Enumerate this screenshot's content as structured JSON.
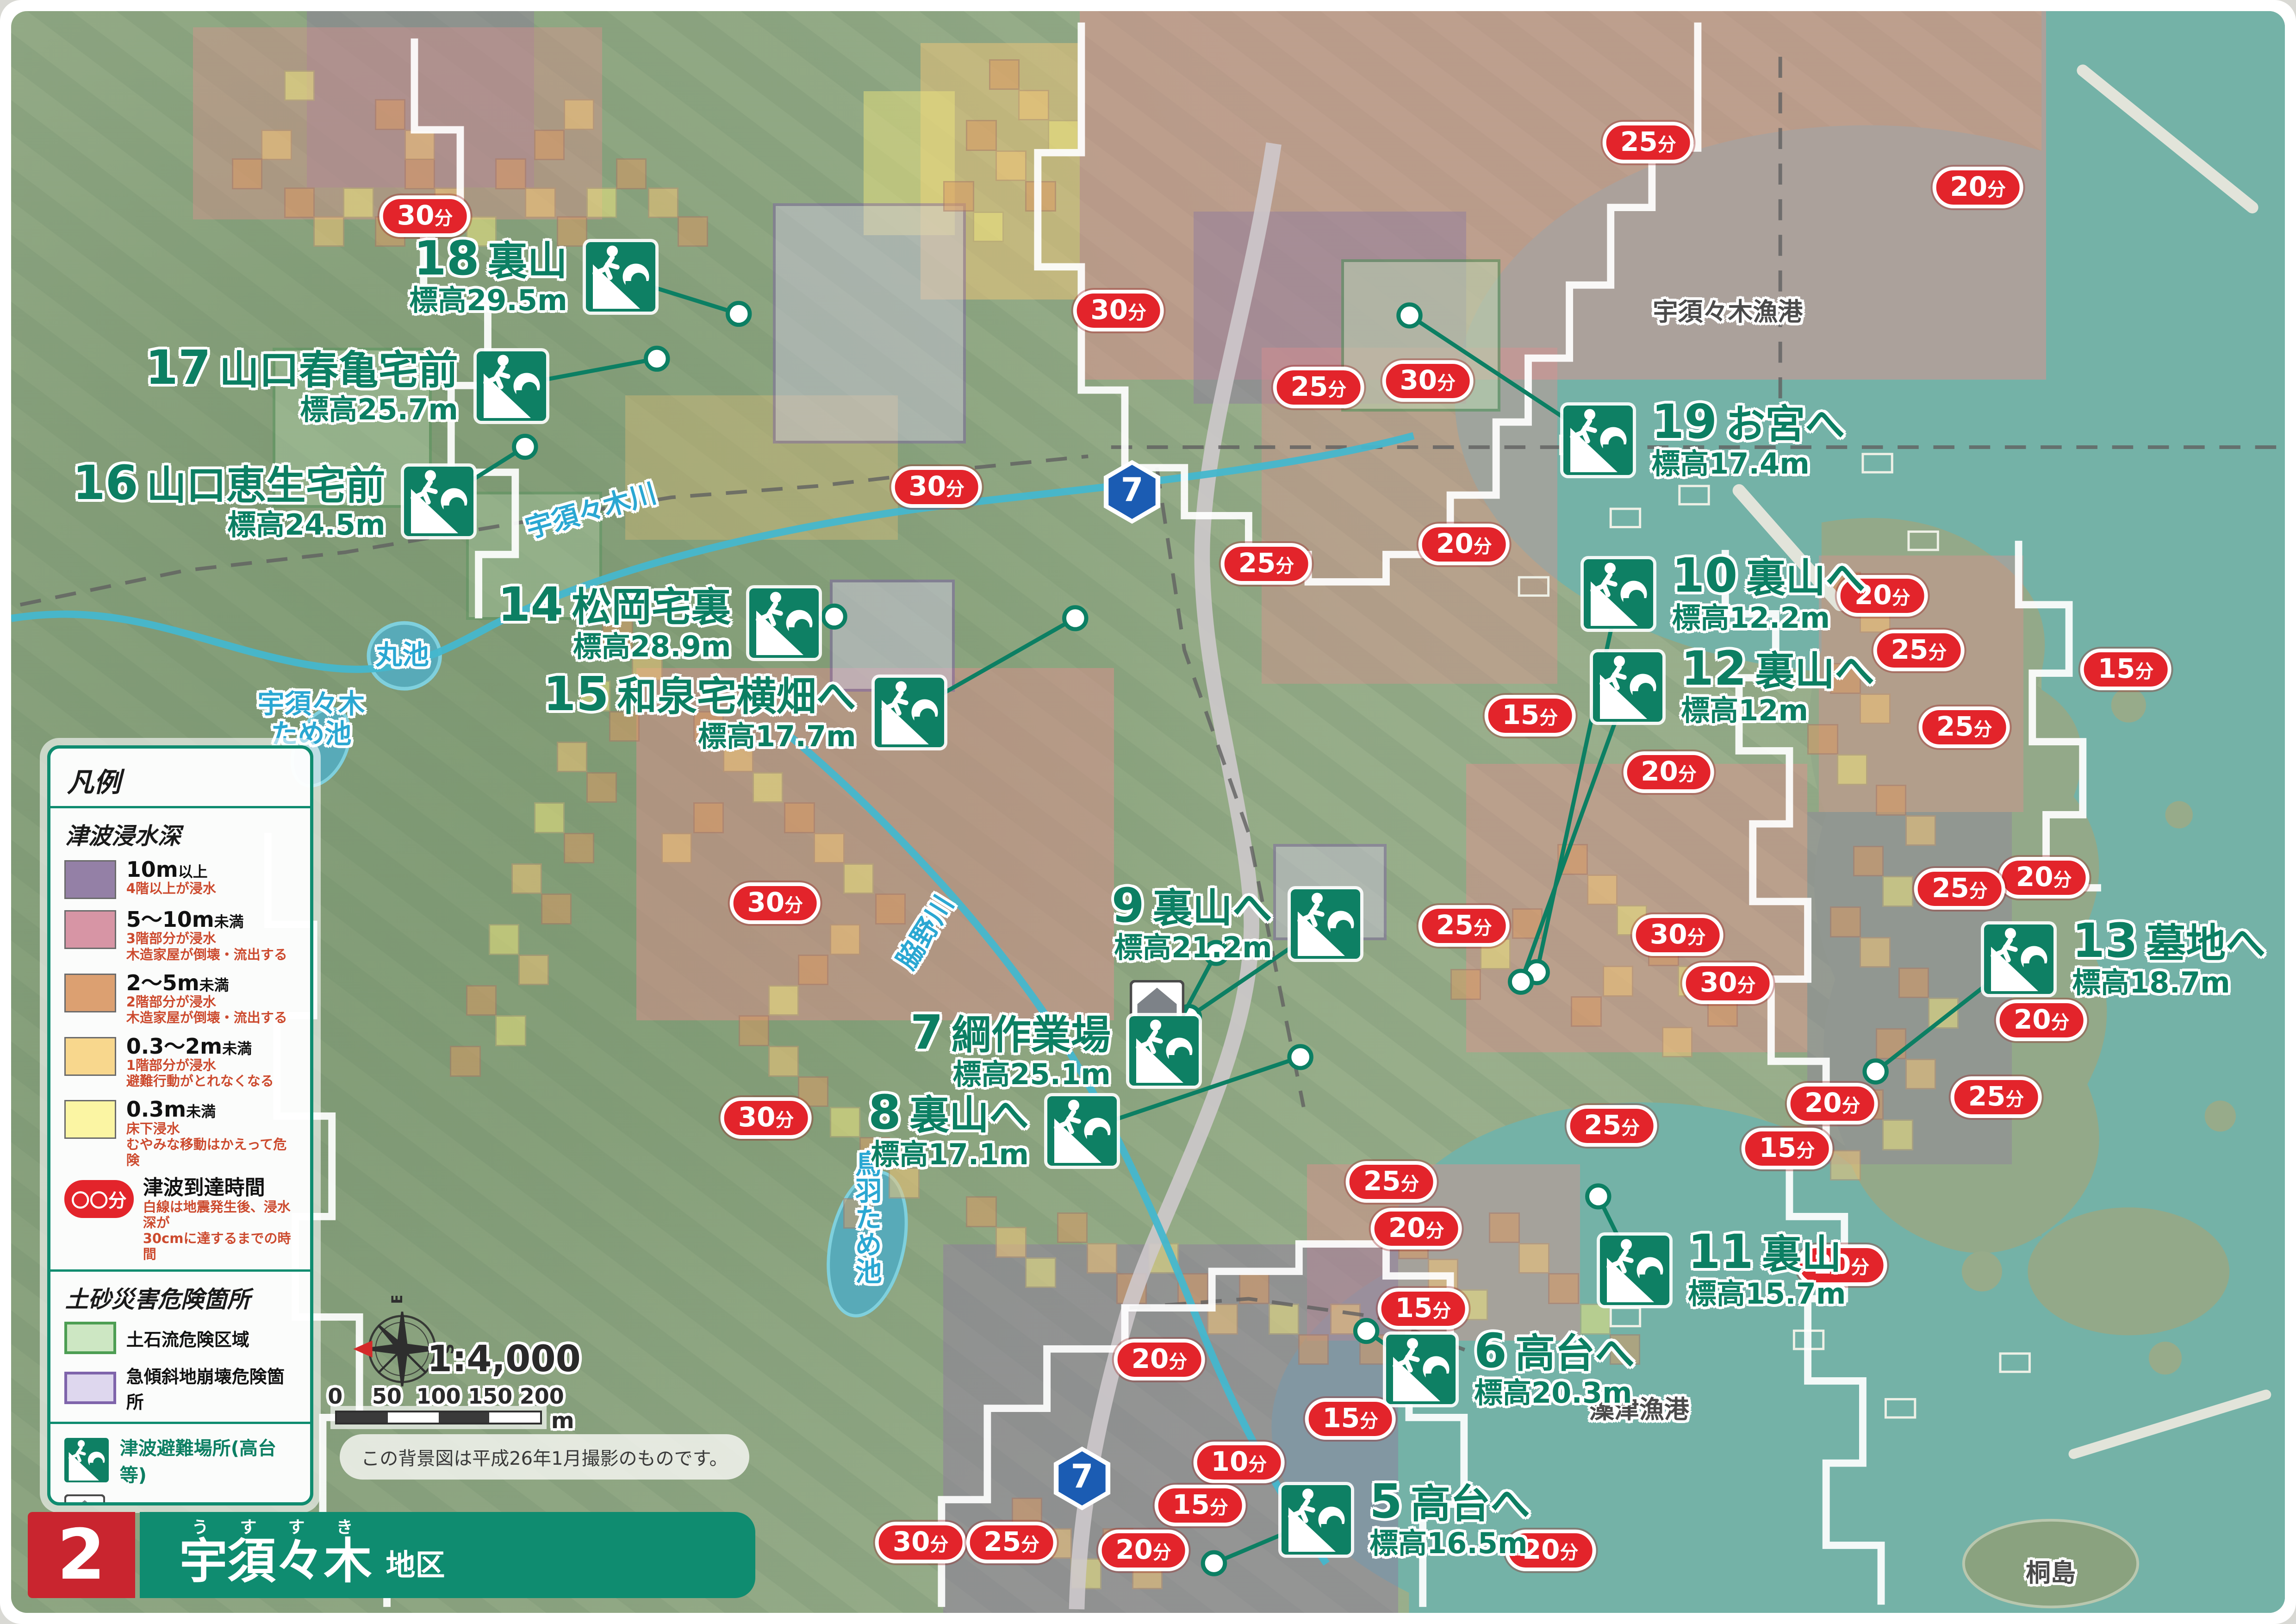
{
  "title_bar": {
    "number": "2",
    "area_ruby": "うすすき",
    "area_name": "宇須々木",
    "area_suffix": "地区"
  },
  "scale": {
    "ratio": "1:4,000",
    "ticks": [
      "0",
      "50",
      "100",
      "150",
      "200"
    ],
    "unit": "m",
    "note": "この背景図は平成26年1月撮影のものです。",
    "compass": {
      "n": "N",
      "e": "E",
      "s": "S",
      "w": "W"
    }
  },
  "legend": {
    "title": "凡例",
    "depth_section": {
      "title": "津波浸水深",
      "items": [
        {
          "color": "#9480a6",
          "label_main": "10m",
          "label_suffix": "以上",
          "desc": [
            "4階以上が浸水"
          ]
        },
        {
          "color": "#d795a5",
          "label_main": "5～10m",
          "label_suffix": "未満",
          "desc": [
            "3階部分が浸水",
            "木造家屋が倒壊・流出する"
          ]
        },
        {
          "color": "#dca071",
          "label_main": "2～5m",
          "label_suffix": "未満",
          "desc": [
            "2階部分が浸水",
            "木造家屋が倒壊・流出する"
          ]
        },
        {
          "color": "#f8d78d",
          "label_main": "0.3～2m",
          "label_suffix": "未満",
          "desc": [
            "1階部分が浸水",
            "避難行動がとれなくなる"
          ]
        },
        {
          "color": "#fbf5a3",
          "label_main": "0.3m",
          "label_suffix": "未満",
          "desc": [
            "床下浸水",
            "むやみな移動はかえって危険"
          ]
        }
      ]
    },
    "time_item": {
      "badge": "〇〇分",
      "label": "津波到達時間",
      "desc": [
        "白線は地震発生後、浸水深が",
        "30cmに達するまでの時間"
      ]
    },
    "sediment_section": {
      "title": "土砂災害危険箇所",
      "items": [
        {
          "fill": "#cde7c3",
          "border": "#4d9e53",
          "label": "土石流危険区域"
        },
        {
          "fill": "#ded7ee",
          "border": "#7f64ab",
          "label": "急傾斜地崩壊危険箇所"
        }
      ]
    },
    "symbol_section": {
      "items": [
        {
          "type": "evac",
          "label": "津波避難場所(高台等)"
        },
        {
          "type": "storage",
          "label": "防災備蓄倉庫"
        },
        {
          "type": "prefroad",
          "shield": "7",
          "label": "県道"
        },
        {
          "type": "cityroad",
          "label": "市道"
        },
        {
          "type": "river",
          "label": "河川・ため池"
        }
      ]
    }
  },
  "map": {
    "evac_points": [
      {
        "num": "18",
        "name": "裏山",
        "elev": "標高29.5m",
        "icon": [
          26.8,
          16.6
        ],
        "side": "left",
        "dot": [
          32.0,
          18.9
        ]
      },
      {
        "num": "17",
        "name": "山口春亀宅前",
        "elev": "標高25.7m",
        "icon": [
          22.0,
          23.4
        ],
        "side": "left",
        "dot": [
          28.4,
          21.7
        ]
      },
      {
        "num": "16",
        "name": "山口恵生宅前",
        "elev": "標高24.5m",
        "icon": [
          18.8,
          30.6
        ],
        "side": "left",
        "dot": [
          22.6,
          27.2
        ]
      },
      {
        "num": "14",
        "name": "松岡宅裏",
        "elev": "標高28.9m",
        "icon": [
          34.0,
          38.2
        ],
        "side": "left",
        "dot": [
          36.2,
          37.8
        ]
      },
      {
        "num": "15",
        "name": "和泉宅横畑へ",
        "elev": "標高17.7m",
        "icon": [
          39.5,
          43.8
        ],
        "side": "left",
        "dot": [
          46.8,
          37.9
        ]
      },
      {
        "num": "19",
        "name": "お宮へ",
        "elev": "標高17.4m",
        "icon": [
          69.8,
          26.8
        ],
        "side": "right",
        "dot": [
          61.5,
          19.0
        ]
      },
      {
        "num": "10",
        "name": "裏山へ",
        "elev": "標高12.2m",
        "icon": [
          70.7,
          36.4
        ],
        "side": "right",
        "dot": [
          67.1,
          60.0
        ]
      },
      {
        "num": "12",
        "name": "裏山へ",
        "elev": "標高12m",
        "icon": [
          71.1,
          42.2
        ],
        "side": "right",
        "dot": [
          66.4,
          60.6
        ]
      },
      {
        "num": "9",
        "name": "裏山へ",
        "elev": "標高21.2m",
        "icon": [
          57.8,
          57.0
        ],
        "side": "left",
        "dot": [
          51.8,
          62.8
        ]
      },
      {
        "num": "7",
        "name": "綱作業場",
        "elev": "標高25.1m",
        "icon": [
          50.7,
          64.9
        ],
        "side": "left",
        "dot": [
          53.0,
          58.8
        ]
      },
      {
        "num": "8",
        "name": "裏山へ",
        "elev": "標高17.1m",
        "icon": [
          47.1,
          69.9
        ],
        "side": "left",
        "dot": [
          56.7,
          65.3
        ]
      },
      {
        "num": "13",
        "name": "墓地へ",
        "elev": "標高18.7m",
        "icon": [
          88.3,
          59.2
        ],
        "side": "right",
        "dot": [
          82.0,
          66.2
        ]
      },
      {
        "num": "11",
        "name": "裏山",
        "elev": "標高15.7m",
        "icon": [
          71.4,
          78.6
        ],
        "side": "right",
        "dot": [
          69.8,
          74.0
        ]
      },
      {
        "num": "6",
        "name": "高台へ",
        "elev": "標高20.3m",
        "icon": [
          62.0,
          84.8
        ],
        "side": "right",
        "dot": [
          59.6,
          82.4
        ]
      },
      {
        "num": "5",
        "name": "高台へ",
        "elev": "標高16.5m",
        "icon": [
          57.4,
          94.2
        ],
        "side": "right",
        "dot": [
          52.9,
          96.9
        ]
      }
    ],
    "badges": [
      [
        "30分",
        18.2,
        12.8
      ],
      [
        "25分",
        72.0,
        8.2
      ],
      [
        "20分",
        86.5,
        11.0
      ],
      [
        "30分",
        48.7,
        18.7
      ],
      [
        "30分",
        62.3,
        23.1
      ],
      [
        "25分",
        57.5,
        23.5
      ],
      [
        "30分",
        40.7,
        29.7
      ],
      [
        "25分",
        55.2,
        34.5
      ],
      [
        "20分",
        63.9,
        33.3
      ],
      [
        "15分",
        66.8,
        44.0
      ],
      [
        "20分",
        72.9,
        47.5
      ],
      [
        "20分",
        82.3,
        36.5
      ],
      [
        "25分",
        83.9,
        39.9
      ],
      [
        "15分",
        93.0,
        41.1
      ],
      [
        "25分",
        85.9,
        44.7
      ],
      [
        "20分",
        89.4,
        54.1
      ],
      [
        "25分",
        85.7,
        54.8
      ],
      [
        "30分",
        33.6,
        55.7
      ],
      [
        "25分",
        63.9,
        57.1
      ],
      [
        "30分",
        73.3,
        57.7
      ],
      [
        "30分",
        75.5,
        60.7
      ],
      [
        "20分",
        89.3,
        63.0
      ],
      [
        "25分",
        87.3,
        67.8
      ],
      [
        "20分",
        80.1,
        68.2
      ],
      [
        "15分",
        78.1,
        71.0
      ],
      [
        "25分",
        70.4,
        69.6
      ],
      [
        "30分",
        33.2,
        69.1
      ],
      [
        "25分",
        60.7,
        73.1
      ],
      [
        "20分",
        61.8,
        76.0
      ],
      [
        "15分",
        62.1,
        81.0
      ],
      [
        "20分",
        80.5,
        78.3
      ],
      [
        "20分",
        50.5,
        84.2
      ],
      [
        "15分",
        58.9,
        87.9
      ],
      [
        "10分",
        54.0,
        90.6
      ],
      [
        "15分",
        52.3,
        93.3
      ],
      [
        "30分",
        40.0,
        95.6
      ],
      [
        "25分",
        44.0,
        95.6
      ],
      [
        "20分",
        49.8,
        96.1
      ],
      [
        "20分",
        67.7,
        96.1
      ]
    ],
    "labels": [
      {
        "text": "宇須々木川",
        "x": 25.5,
        "y": 31.2,
        "kind": "water",
        "rot": -16
      },
      {
        "text": "丸池",
        "x": 17.2,
        "y": 40.2,
        "kind": "water",
        "rot": 0
      },
      {
        "text": "宇須々木\nため池",
        "x": 13.2,
        "y": 44.2,
        "kind": "water",
        "rot": 0
      },
      {
        "text": "脇野川",
        "x": 40.2,
        "y": 57.5,
        "kind": "water",
        "rot": -58
      },
      {
        "text": "鳥羽ため池",
        "x": 37.6,
        "y": 75.3,
        "kind": "water",
        "rot": 0,
        "vertical": true
      },
      {
        "text": "宇須々木漁港",
        "x": 75.5,
        "y": 18.8,
        "kind": "place",
        "rot": 0
      },
      {
        "text": "藻津漁港",
        "x": 71.6,
        "y": 87.3,
        "kind": "place",
        "rot": 0
      },
      {
        "text": "桐島",
        "x": 89.7,
        "y": 97.5,
        "kind": "place",
        "rot": 0
      }
    ],
    "shields": [
      {
        "text": "7",
        "x": 49.3,
        "y": 30.0
      },
      {
        "text": "7",
        "x": 47.1,
        "y": 91.6
      }
    ],
    "storage_marker": {
      "x": 50.4,
      "y": 62.2
    },
    "zones": [
      {
        "c": "#e28f8f",
        "x": 47,
        "y": 0,
        "w": 42.5,
        "h": 23,
        "o": 0.5
      },
      {
        "c": "#8f7c9e",
        "x": 52,
        "y": 12.5,
        "w": 12,
        "h": 12,
        "o": 0.5
      },
      {
        "c": "#8f7c9e",
        "x": 13,
        "y": 0,
        "w": 10,
        "h": 11,
        "o": 0.45
      },
      {
        "c": "#e28f8f",
        "x": 8,
        "y": 1,
        "w": 18,
        "h": 12,
        "o": 0.4
      },
      {
        "c": "#f2c577",
        "x": 40,
        "y": 2,
        "w": 7,
        "h": 16,
        "o": 0.5
      },
      {
        "c": "#ece47e",
        "x": 37.5,
        "y": 5,
        "w": 4,
        "h": 9,
        "o": 0.5
      },
      {
        "c": "#f2c577",
        "x": 27,
        "y": 24,
        "w": 12,
        "h": 9,
        "o": 0.32
      },
      {
        "c": "#e28f8f",
        "x": 27.5,
        "y": 41,
        "w": 21,
        "h": 22,
        "o": 0.48
      },
      {
        "c": "#e28f8f",
        "x": 55,
        "y": 21,
        "w": 13,
        "h": 21,
        "o": 0.4
      },
      {
        "c": "#e28f8f",
        "x": 64,
        "y": 47,
        "w": 15,
        "h": 18,
        "o": 0.45
      },
      {
        "c": "#e28f8f",
        "x": 57,
        "y": 72,
        "w": 12,
        "h": 11,
        "o": 0.45
      },
      {
        "c": "#8f7c9e",
        "x": 41,
        "y": 77,
        "w": 20,
        "h": 23,
        "o": 0.5
      },
      {
        "c": "#8f7c9e",
        "x": 79,
        "y": 50,
        "w": 9,
        "h": 22,
        "o": 0.4
      },
      {
        "c": "#e28f8f",
        "x": 79.5,
        "y": 34,
        "w": 9,
        "h": 16,
        "o": 0.4
      },
      {
        "c": "#cfc8e2",
        "x": 33.5,
        "y": 12,
        "w": 8.5,
        "h": 15,
        "o": 0.45,
        "b": "#7b5ea6"
      },
      {
        "c": "#cfc8e2",
        "x": 36,
        "y": 35.5,
        "w": 5.5,
        "h": 7,
        "o": 0.5,
        "b": "#7b5ea6"
      },
      {
        "c": "#cfc8e2",
        "x": 55.5,
        "y": 52,
        "w": 5,
        "h": 6,
        "o": 0.45,
        "b": "#7b5ea6"
      },
      {
        "c": "#bcdcb4",
        "x": 58.5,
        "y": 15.5,
        "w": 7,
        "h": 9.5,
        "o": 0.5,
        "b": "#3f8f4f"
      },
      {
        "c": "#bcdcb4",
        "x": 11.5,
        "y": 21,
        "w": 7,
        "h": 10,
        "o": 0.35,
        "b": "#3f8f4f"
      },
      {
        "c": "#bcdcb4",
        "x": 20,
        "y": 30,
        "w": 6,
        "h": 8,
        "o": 0.3,
        "b": "#3f8f4f"
      }
    ],
    "squares": [
      [
        12,
        11,
        "o"
      ],
      [
        13.3,
        12.8,
        "l"
      ],
      [
        14.6,
        11,
        "y"
      ],
      [
        16,
        12.8,
        "o"
      ],
      [
        17.3,
        9.2,
        "o"
      ],
      [
        18.6,
        11,
        "l"
      ],
      [
        20,
        12.8,
        "y"
      ],
      [
        11,
        7.4,
        "l"
      ],
      [
        9.7,
        9.2,
        "o"
      ],
      [
        21.3,
        9.2,
        "o"
      ],
      [
        22.6,
        11,
        "l"
      ],
      [
        24,
        12.8,
        "o"
      ],
      [
        25.3,
        11,
        "y"
      ],
      [
        16,
        5.5,
        "o"
      ],
      [
        17.3,
        7.4,
        "l"
      ],
      [
        12,
        3.7,
        "y"
      ],
      [
        23,
        7.4,
        "o"
      ],
      [
        24.3,
        5.5,
        "l"
      ],
      [
        26.6,
        9.2,
        "o"
      ],
      [
        28,
        11,
        "l"
      ],
      [
        29.3,
        12.8,
        "o"
      ],
      [
        43,
        3,
        "o"
      ],
      [
        44.3,
        4.9,
        "l"
      ],
      [
        45.6,
        6.8,
        "y"
      ],
      [
        42,
        6.8,
        "o"
      ],
      [
        43.3,
        8.7,
        "l"
      ],
      [
        41,
        10.6,
        "o"
      ],
      [
        42.3,
        12.5,
        "y"
      ],
      [
        44.6,
        10.6,
        "o"
      ],
      [
        26,
        38,
        "o"
      ],
      [
        27.3,
        39.9,
        "l"
      ],
      [
        25,
        41.8,
        "y"
      ],
      [
        26.3,
        43.7,
        "o"
      ],
      [
        24,
        45.6,
        "l"
      ],
      [
        25.3,
        47.5,
        "o"
      ],
      [
        23,
        49.4,
        "y"
      ],
      [
        24.3,
        51.3,
        "o"
      ],
      [
        22,
        53.2,
        "l"
      ],
      [
        23.3,
        55.1,
        "o"
      ],
      [
        21,
        57,
        "y"
      ],
      [
        22.3,
        58.9,
        "l"
      ],
      [
        20,
        60.8,
        "o"
      ],
      [
        21.3,
        62.7,
        "y"
      ],
      [
        19.3,
        64.6,
        "o"
      ],
      [
        30,
        43.7,
        "o"
      ],
      [
        31.3,
        45.6,
        "l"
      ],
      [
        32.6,
        47.5,
        "y"
      ],
      [
        30,
        49.4,
        "o"
      ],
      [
        28.6,
        51.3,
        "l"
      ],
      [
        34,
        49.4,
        "o"
      ],
      [
        35.3,
        51.3,
        "l"
      ],
      [
        36.6,
        53.2,
        "y"
      ],
      [
        38,
        55.1,
        "o"
      ],
      [
        36,
        57,
        "l"
      ],
      [
        34.6,
        58.9,
        "o"
      ],
      [
        33.3,
        60.8,
        "y"
      ],
      [
        32,
        62.7,
        "o"
      ],
      [
        33.3,
        64.6,
        "l"
      ],
      [
        34.6,
        66.5,
        "o"
      ],
      [
        36,
        68.4,
        "y"
      ],
      [
        37.3,
        70.3,
        "o"
      ],
      [
        38.6,
        72.2,
        "l"
      ],
      [
        36.6,
        74.1,
        "o"
      ],
      [
        80,
        35,
        "o"
      ],
      [
        81.3,
        36.9,
        "l"
      ],
      [
        82.6,
        38.8,
        "y"
      ],
      [
        80,
        40.7,
        "o"
      ],
      [
        81.3,
        42.6,
        "l"
      ],
      [
        79,
        44.5,
        "o"
      ],
      [
        80.3,
        46.4,
        "y"
      ],
      [
        82,
        48.3,
        "o"
      ],
      [
        83.3,
        50.2,
        "l"
      ],
      [
        81,
        52.1,
        "o"
      ],
      [
        82.3,
        54,
        "y"
      ],
      [
        80,
        55.9,
        "o"
      ],
      [
        81.3,
        57.8,
        "l"
      ],
      [
        83,
        59.7,
        "o"
      ],
      [
        84.3,
        61.6,
        "y"
      ],
      [
        82,
        63.5,
        "o"
      ],
      [
        83.3,
        65.4,
        "l"
      ],
      [
        81,
        67.3,
        "o"
      ],
      [
        82.3,
        69.2,
        "y"
      ],
      [
        80,
        71.1,
        "l"
      ],
      [
        42,
        74,
        "o"
      ],
      [
        43.3,
        75.9,
        "l"
      ],
      [
        44.6,
        77.8,
        "y"
      ],
      [
        46,
        75,
        "o"
      ],
      [
        47.3,
        76.9,
        "l"
      ],
      [
        48.6,
        78.8,
        "o"
      ],
      [
        50,
        76.9,
        "y"
      ],
      [
        51.3,
        78.8,
        "o"
      ],
      [
        52.6,
        80.7,
        "l"
      ],
      [
        54,
        78.8,
        "o"
      ],
      [
        55.3,
        80.7,
        "y"
      ],
      [
        56.6,
        82.6,
        "o"
      ],
      [
        58,
        80.7,
        "l"
      ],
      [
        59.3,
        82.6,
        "o"
      ],
      [
        60.6,
        84.5,
        "y"
      ],
      [
        44,
        92.8,
        "o"
      ],
      [
        45.3,
        94.7,
        "l"
      ],
      [
        46.6,
        96.6,
        "y"
      ],
      [
        48,
        94.7,
        "o"
      ],
      [
        49.3,
        96.6,
        "l"
      ],
      [
        61,
        76,
        "o"
      ],
      [
        62.3,
        77.9,
        "l"
      ],
      [
        63.6,
        79.8,
        "y"
      ],
      [
        65,
        75,
        "o"
      ],
      [
        66.3,
        76.9,
        "l"
      ],
      [
        67.6,
        78.8,
        "o"
      ],
      [
        69,
        80.7,
        "y"
      ],
      [
        70.3,
        82.6,
        "o"
      ],
      [
        68,
        52,
        "o"
      ],
      [
        69.3,
        53.9,
        "l"
      ],
      [
        70.6,
        55.8,
        "y"
      ],
      [
        72,
        57.7,
        "o"
      ],
      [
        70,
        59.6,
        "l"
      ],
      [
        68.6,
        61.5,
        "o"
      ],
      [
        73.3,
        59.6,
        "y"
      ],
      [
        74.6,
        61.5,
        "o"
      ],
      [
        72.6,
        63.4,
        "l"
      ],
      [
        66,
        56,
        "o"
      ],
      [
        64.6,
        57.9,
        "y"
      ],
      [
        63.3,
        59.8,
        "o"
      ]
    ],
    "square_colors": {
      "o": "#d99a63",
      "l": "#f2c577",
      "y": "#ece47e"
    }
  }
}
